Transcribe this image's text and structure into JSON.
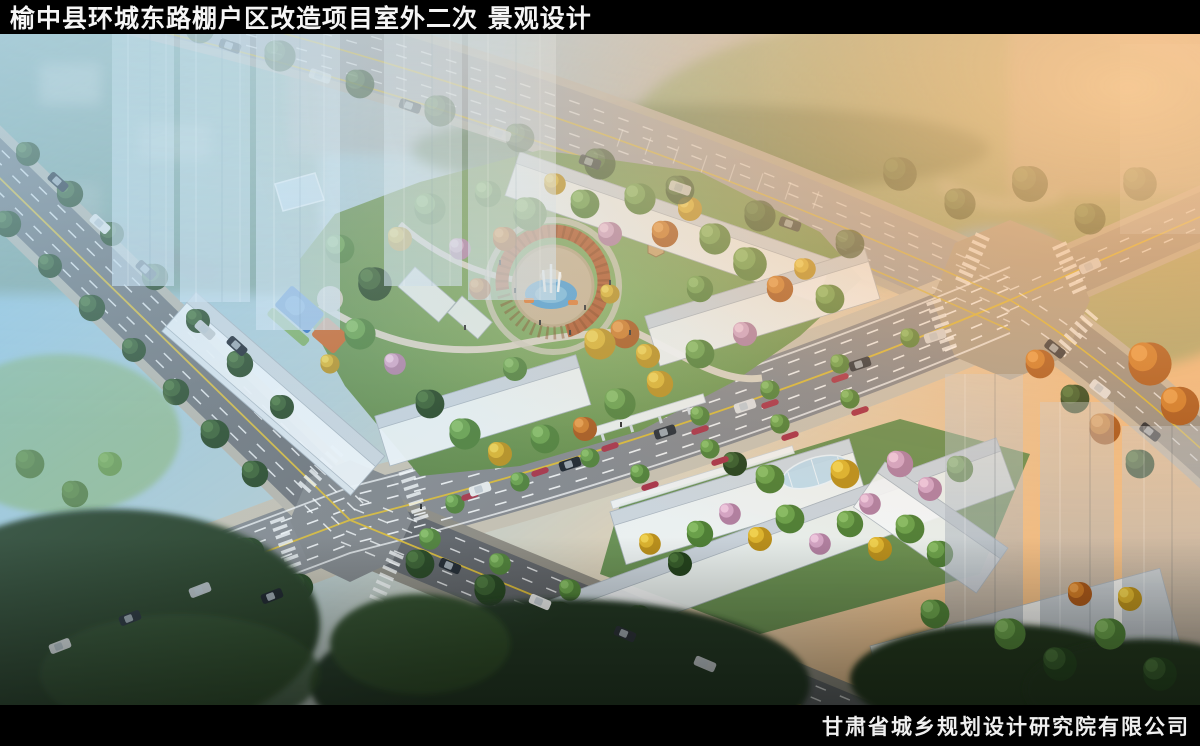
{
  "title_bar": {
    "text": "榆中县环城东路棚户区改造项目室外二次 景观设计"
  },
  "footer_bar": {
    "text": "甘肃省城乡规划设计研究院有限公司"
  },
  "scene": {
    "kind": "aerial-landscape-architecture-rendering",
    "palette": {
      "bar_black": "#000000",
      "bar_text_white": "#f5f5f5",
      "sky_haze_blue": "#a5d7ee",
      "sunset_glow_orange": "#f7a64d",
      "road_asphalt_gray": "#87898c",
      "road_dark_gray": "#606266",
      "lane_line_yellow": "#d9b836",
      "lane_line_white": "#ffffff",
      "building_white": "#f3f6f9",
      "building_shadow_gray": "#c3ccd4",
      "park_green": "#5d8a43",
      "tree_dark_green": "#2c4a24",
      "tree_yellow": "#e6c12e",
      "tree_orange": "#d97a1e",
      "blossom_pink": "#e9b9d2",
      "fountain_pool_blue": "#4f9fd4",
      "pergola_ring_orange": "#b3592a",
      "playground_blue": "#2f6fc0",
      "playground_orange": "#cc6426"
    }
  }
}
